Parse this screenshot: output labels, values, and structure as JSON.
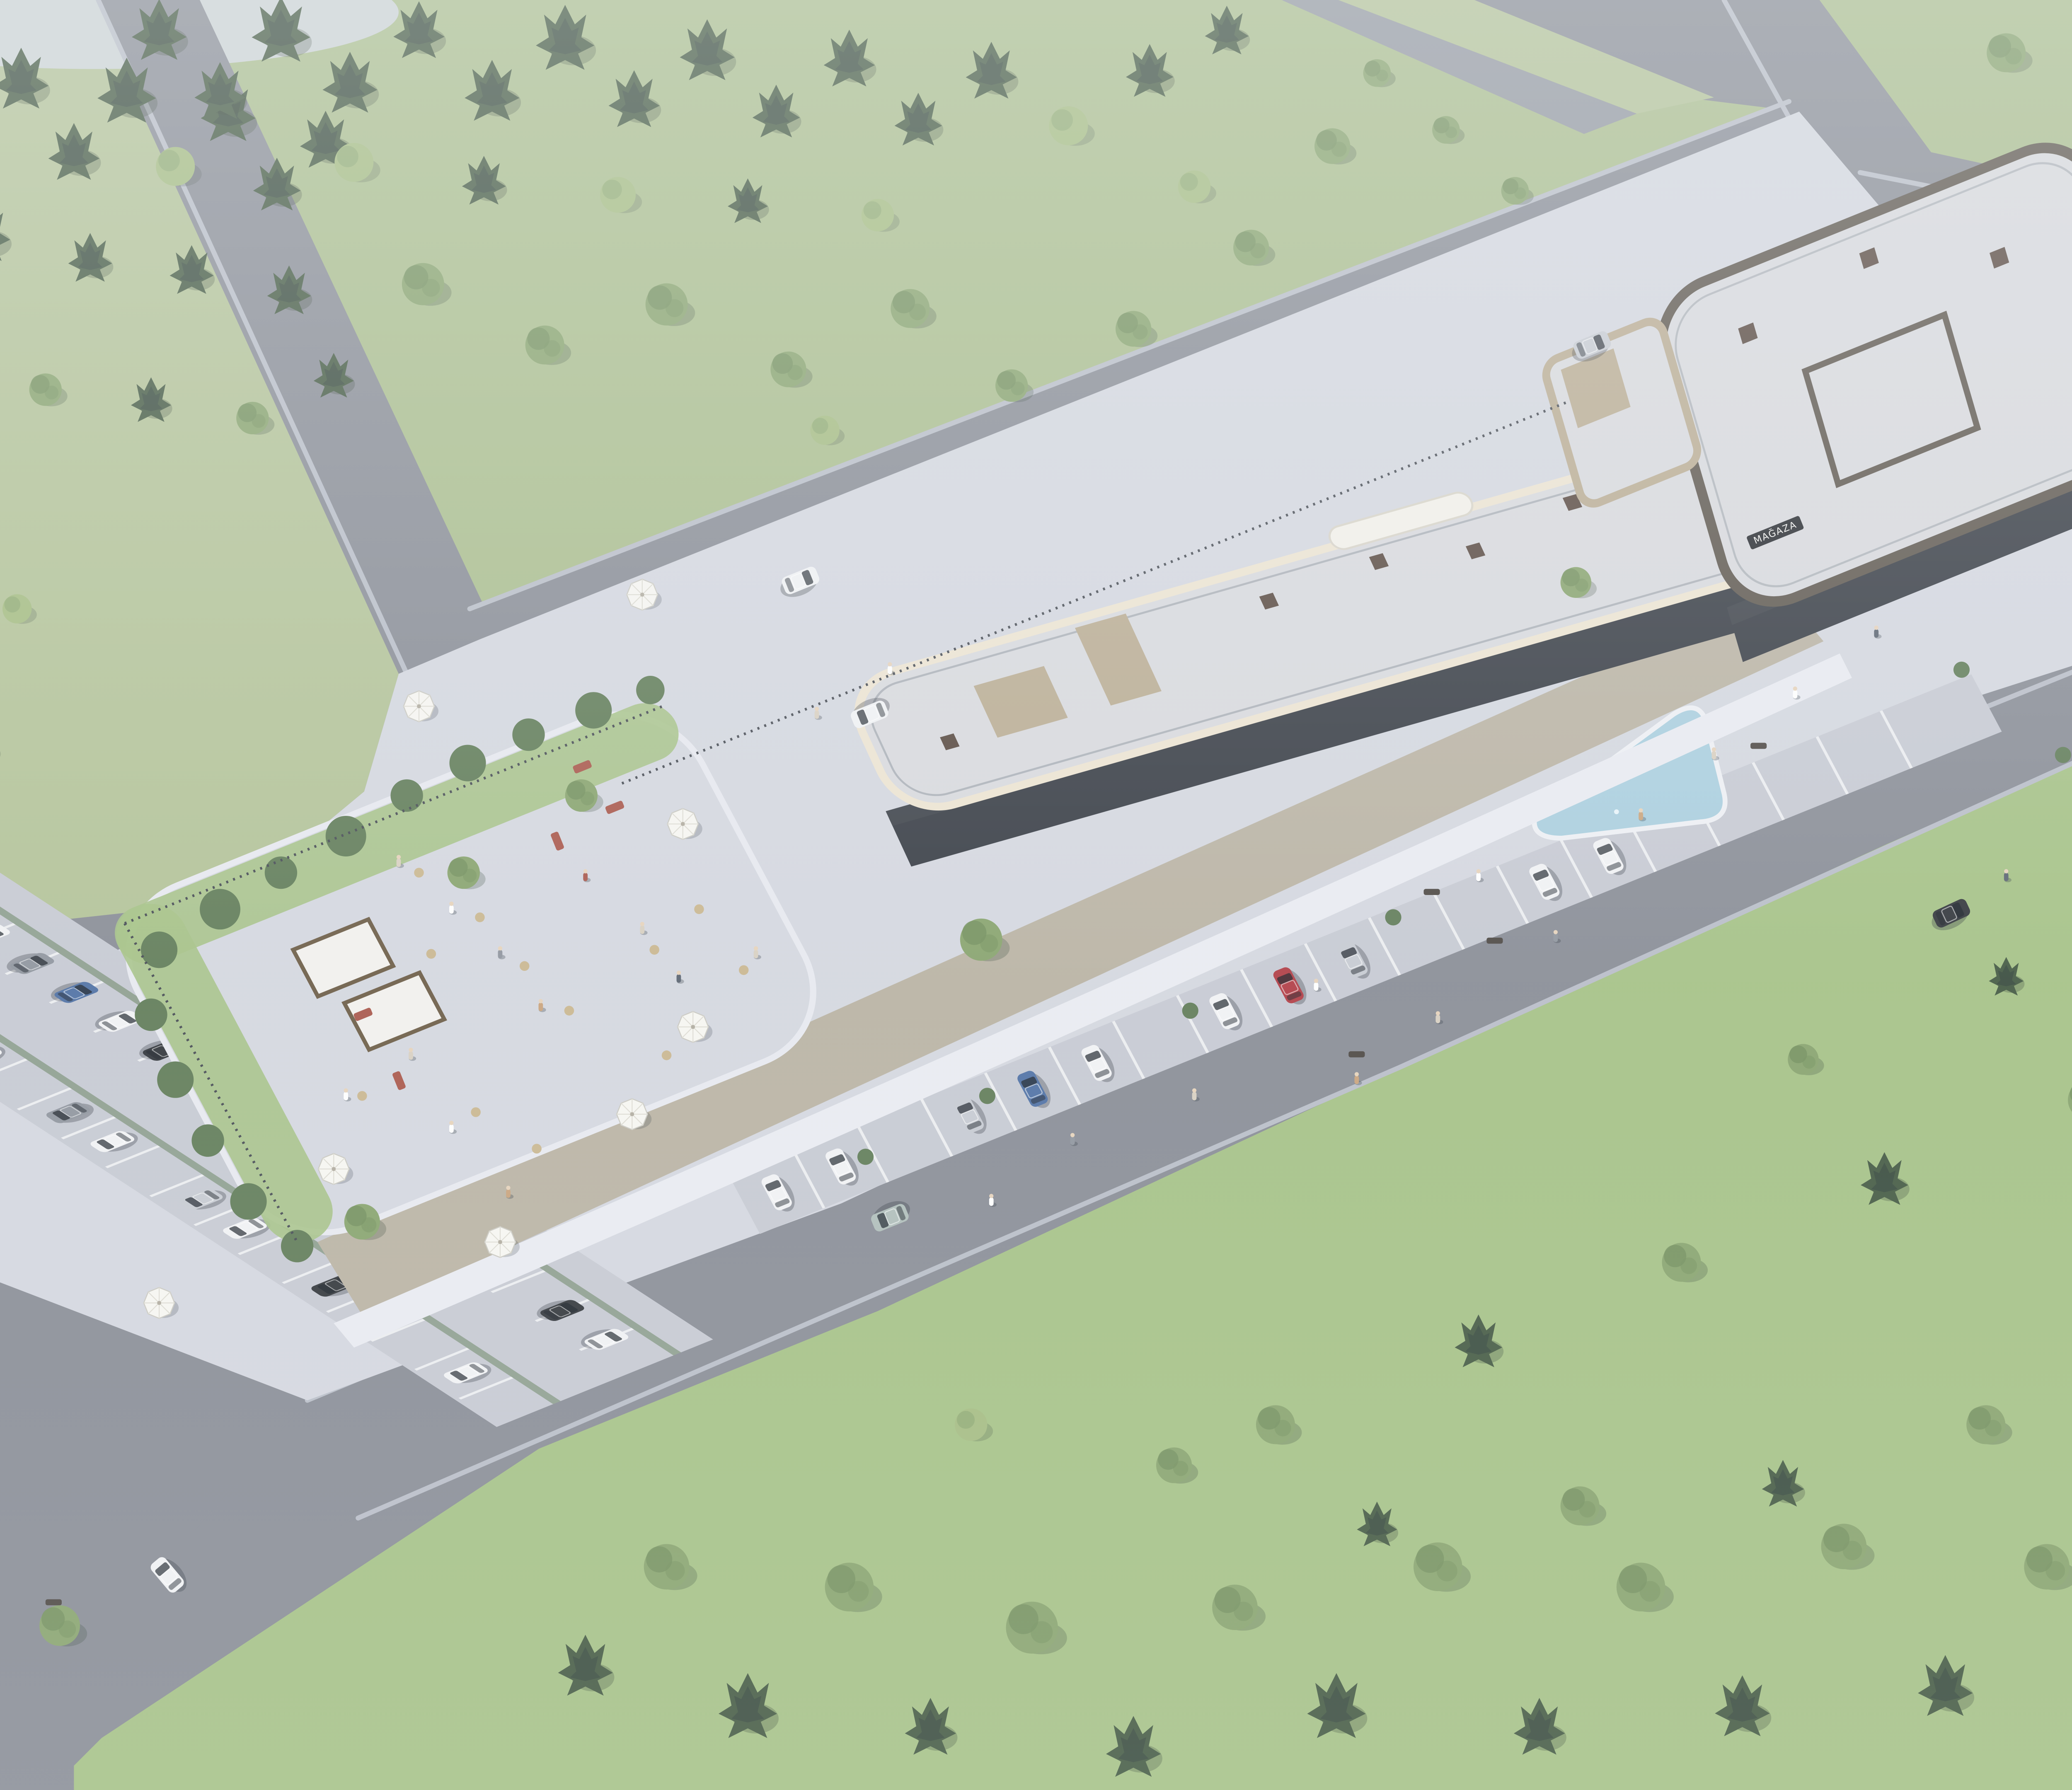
{
  "meta": {
    "title": "Aerial visualization — two-storey retail and leisure complex with rooftop terrace",
    "type": "3D architectural rendering",
    "view": "high-angle oblique bird's-eye"
  },
  "environment": {
    "lighting": "soft overcast daylight with atmospheric haze",
    "setting": "suburban parkland block bounded by asphalt roads",
    "landscape": "sage-green lawns, dense conifer and deciduous tree belts, small pale pond at top-left"
  },
  "signage": {
    "storefront_vertical": "MAĞAZA"
  },
  "site": {
    "west_wing": "long 2-storey retail strip, white-gravel roof, cream parapet bands, glass fronts with dark louvre canopies, timber promenade",
    "east_wing": "2-storey anchor block, dark taupe walls, rounded glass corner cafe, white-gravel roof",
    "rooftop_terrace": {
      "white_parasols": 8,
      "pergolas": 2,
      "lounge_sofas": "terracotta cushions",
      "green_roof_border": true,
      "guests_visible_approx": 60
    },
    "plaza": {
      "fountain": "triangular reflecting pool with jets",
      "benches": 6,
      "planting": "lavender and ornamental grasses"
    },
    "parking": {
      "main_lot_cars": 23,
      "angled_street_cars": 10,
      "surface": "cobble setts with white stall striping"
    },
    "cars_driving": 10,
    "car_colors": [
      "white",
      "silver",
      "grey",
      "black",
      "red",
      "dark red",
      "blue",
      "sage"
    ],
    "pedestrians_approx": 40
  },
  "palette": {
    "grass": "#a9bd8c",
    "grass_bright": "#a4c184",
    "grass_pale": "#b2c296",
    "road": "#878b94",
    "road_light": "#9297a0",
    "curb": "#b8bdc7",
    "plaza": "#d4d7df",
    "cobble": "#c6c9d2",
    "deck": "#b9b2a2",
    "path": "#e9ebf1",
    "roof_gravel": "#d8d9dd",
    "parapet": "#ede4d1",
    "wall_tan": "#b9ab91",
    "wall_dark": "#5b544b",
    "glass": "#333840",
    "slat": "#3a3f46",
    "fence": "#434850",
    "water": "#a9cede",
    "pond": "#ccd3d5",
    "conifer": "#41573f",
    "conifer_dark": "#35483a",
    "leaf": "#86a26b",
    "leaf_dark": "#6f8d5a",
    "leaf_light": "#a3bb7f",
    "bush": "#5e7a55",
    "sofa": "#a85548",
    "table": "#c9b68e",
    "car_white": "#f1f2f4",
    "car_silver": "#c6cad1",
    "car_gray": "#8d939c",
    "car_black": "#2e3237",
    "car_red": "#b03a42",
    "car_darkred": "#7e2f36",
    "car_blue": "#4d6fa3",
    "car_sage": "#aebdb9",
    "umbrella": "#f7f6f1",
    "haze": "#eef2f5"
  }
}
